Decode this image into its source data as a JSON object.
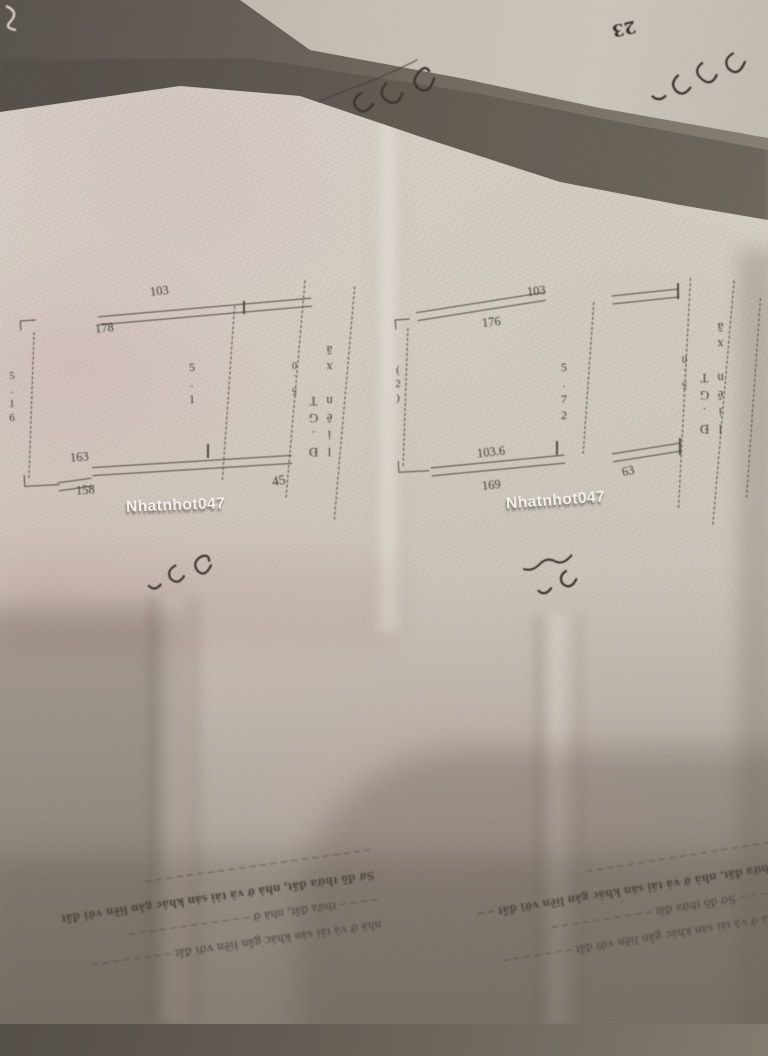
{
  "watermark": {
    "text": "Nhatnhot047",
    "color": "#faf8f4"
  },
  "top_sheet": {
    "number": "23"
  },
  "left_page": {
    "diagram": {
      "top_number": "103",
      "top_left_number": "178",
      "center_dimension": "5.1",
      "left_dimension": "5.16",
      "bottom_left_number_above": "163",
      "bottom_left_number_below": "158",
      "bottom_right_number": "45",
      "road_label": "Đ.GT liên xã",
      "road_dimension": "5.0"
    },
    "form_lines": [
      "nhà ở và tài sản khác gắn liền với đất – – – – – – – –",
      "– – – – thửa đất, nhà ở – – – – – – – – – – – –",
      "Sơ đồ thửa đất, nhà ở và tài sản khác gắn liền với đất",
      "– – – – – – – – – – – – – – – – – – – – – –"
    ]
  },
  "right_page": {
    "diagram": {
      "top_number": "103",
      "top_left_number": "176",
      "center_dimension": "5.72",
      "left_dimension": "(2)",
      "bottom_left_number_above": "103.6",
      "bottom_left_number_below": "169",
      "bottom_right_number": "63",
      "road_label": "Đ.GT liên xã",
      "road_dimension": "5.0"
    },
    "form_lines": [
      "nhà ở và tài sản khác gắn liền với đất – – – – – – –",
      "– – – – Sơ đồ thửa đất – – – – – – – – – –",
      "thửa đất, nhà ở và tài sản khác gắn liền với đất – –",
      "– – – – – – – – – – – – – – – – – –"
    ]
  },
  "colors": {
    "paper": "#d9d3c9",
    "paper_pink": "#e0ccce",
    "top_shadow": "#55504a",
    "ink": "#4a443c",
    "form_ink": "#3b352e"
  }
}
